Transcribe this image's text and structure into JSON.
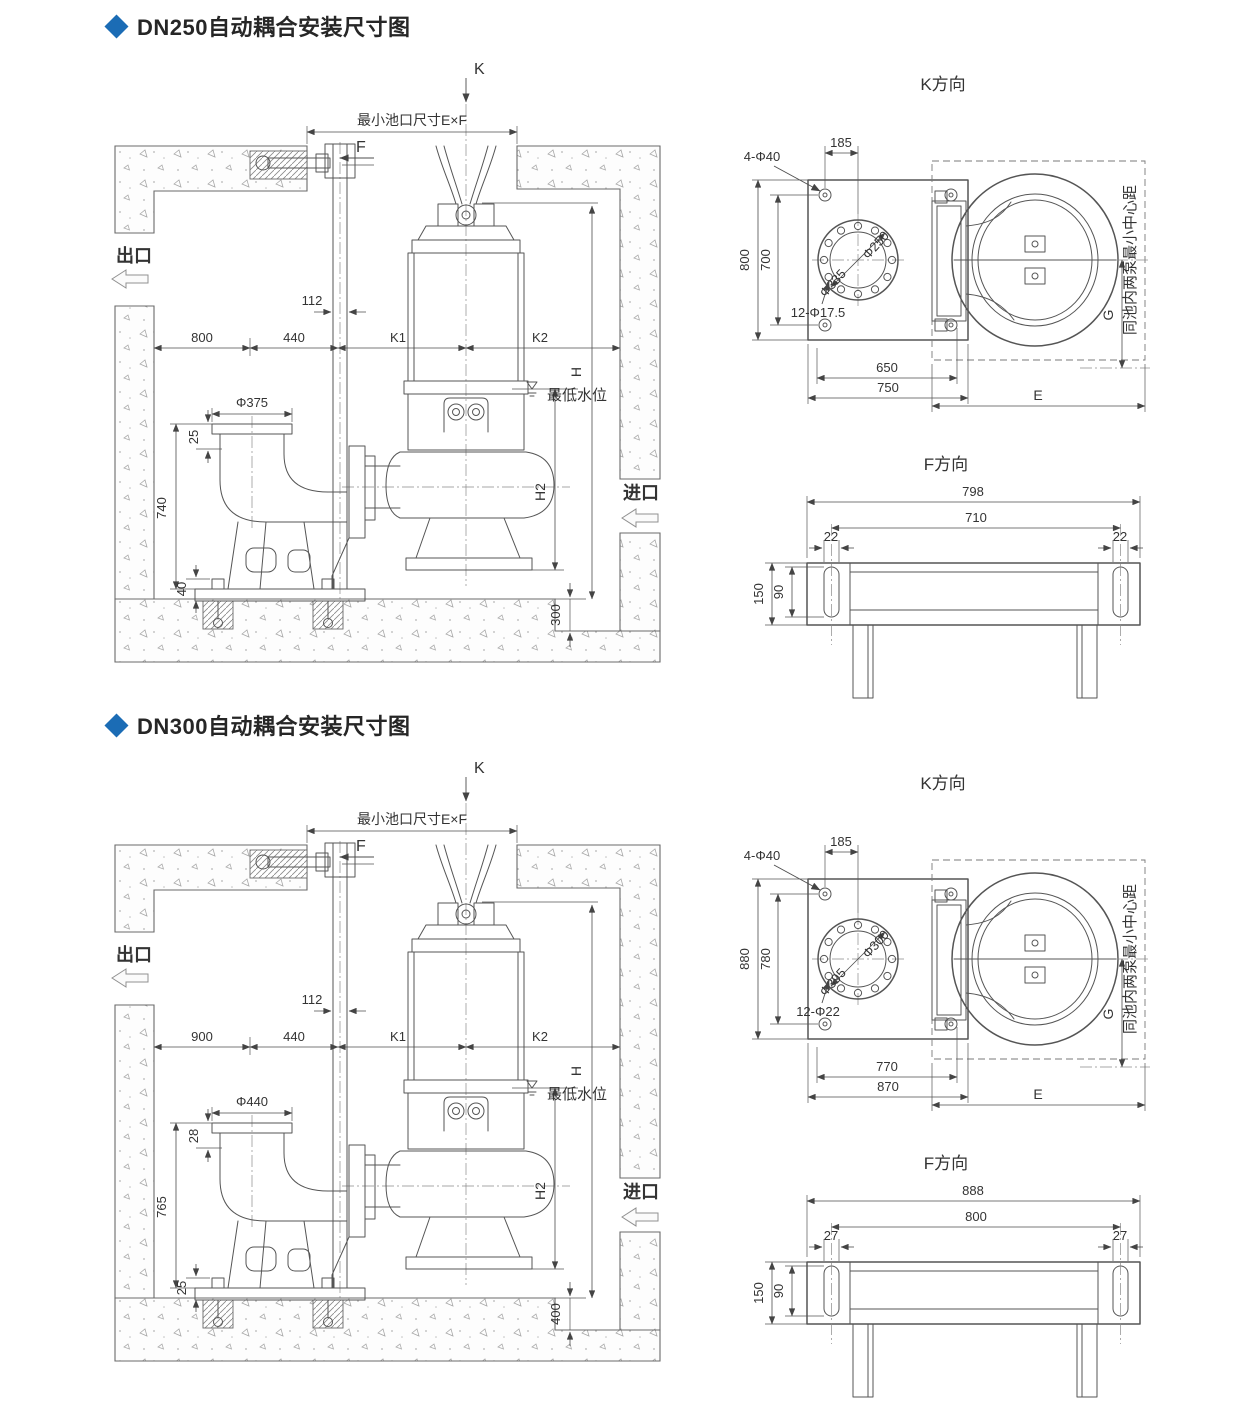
{
  "accent_color": "#1b6cb5",
  "line_color": "#555555",
  "sections": [
    {
      "title": "DN250自动耦合安装尺寸图",
      "elevation": {
        "k_arrow": "K",
        "pool_dim": "最小池口尺寸E×F",
        "f_arrow": "F",
        "outlet": "出口",
        "inlet": "进口",
        "rail_width": "112",
        "d1": "800",
        "d2": "440",
        "k1": "K1",
        "k2": "K2",
        "h": "H",
        "h2": "H2",
        "min_water": "最低水位",
        "flange": "Φ375",
        "flange_drop": "25",
        "elbow_h": "740",
        "anchor_h": "40",
        "sump_depth": "300"
      },
      "k_view": {
        "title": "K方向",
        "bolts": "4-Φ40",
        "d185": "185",
        "dv1": "800",
        "dv2": "700",
        "fo": "Φ335",
        "fi": "Φ250",
        "bc": "12-Φ17.5",
        "db1": "650",
        "db2": "750",
        "e": "E",
        "g": "G",
        "note": "同池内两泵最小中心距"
      },
      "f_view": {
        "title": "F方向",
        "dt": "798",
        "di": "710",
        "sl": "22",
        "sr": "22",
        "dh": "150",
        "ds": "90"
      }
    },
    {
      "title": "DN300自动耦合安装尺寸图",
      "elevation": {
        "k_arrow": "K",
        "pool_dim": "最小池口尺寸E×F",
        "f_arrow": "F",
        "outlet": "出口",
        "inlet": "进口",
        "rail_width": "112",
        "d1": "900",
        "d2": "440",
        "k1": "K1",
        "k2": "K2",
        "h": "H",
        "h2": "H2",
        "min_water": "最低水位",
        "flange": "Φ440",
        "flange_drop": "28",
        "elbow_h": "765",
        "anchor_h": "25",
        "sump_depth": "400"
      },
      "k_view": {
        "title": "K方向",
        "bolts": "4-Φ40",
        "d185": "185",
        "dv1": "880",
        "dv2": "780",
        "fo": "Φ395",
        "fi": "Φ300",
        "bc": "12-Φ22",
        "db1": "770",
        "db2": "870",
        "e": "E",
        "g": "G",
        "note": "同池内两泵最小中心距"
      },
      "f_view": {
        "title": "F方向",
        "dt": "888",
        "di": "800",
        "sl": "27",
        "sr": "27",
        "dh": "150",
        "ds": "90"
      }
    }
  ]
}
